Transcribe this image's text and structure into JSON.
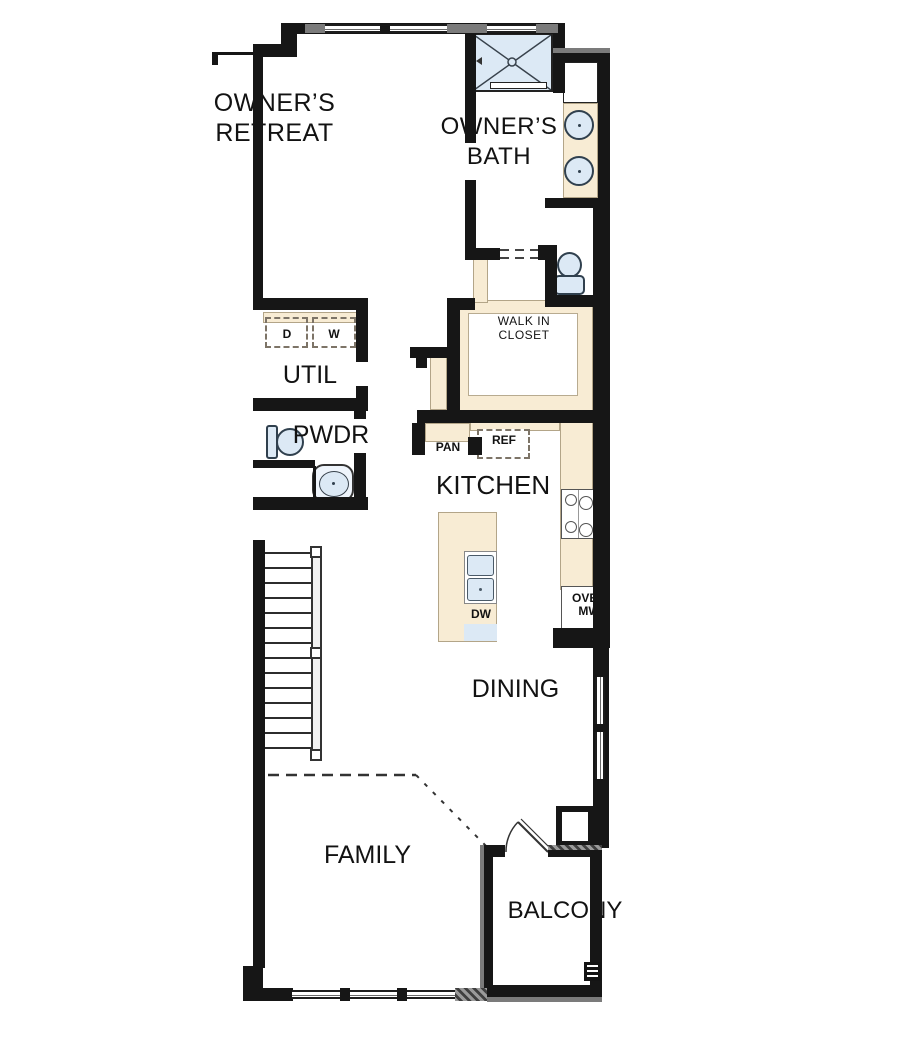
{
  "meta": {
    "type": "architectural floor plan",
    "level": "second floor unit"
  },
  "colors": {
    "wall": "#161616",
    "wall_cap_gray": "#7b7b7b",
    "counter_tan": "#f8ecd4",
    "fixture_blue": "#dce9f5",
    "floor": "#ffffff",
    "text": "#121212"
  },
  "rooms": {
    "owners_retreat": {
      "line1": "OWNER’S",
      "line2": "RETREAT"
    },
    "owners_bath": {
      "line1": "OWNER’S",
      "line2": "BATH"
    },
    "walk_in_closet": {
      "line1": "WALK IN",
      "line2": "CLOSET"
    },
    "util": {
      "label": "UTIL"
    },
    "pwdr": {
      "label": "PWDR"
    },
    "kitchen": {
      "label": "KITCHEN"
    },
    "dining": {
      "label": "DINING"
    },
    "family": {
      "label": "FAMILY"
    },
    "balcony": {
      "label": "BALCONY"
    }
  },
  "appliances": {
    "dryer": "D",
    "washer": "W",
    "pantry": "PAN",
    "refrigerator": "REF",
    "dishwasher_island": "DW",
    "oven_line1": "OVEN",
    "oven_line2": "MW"
  }
}
